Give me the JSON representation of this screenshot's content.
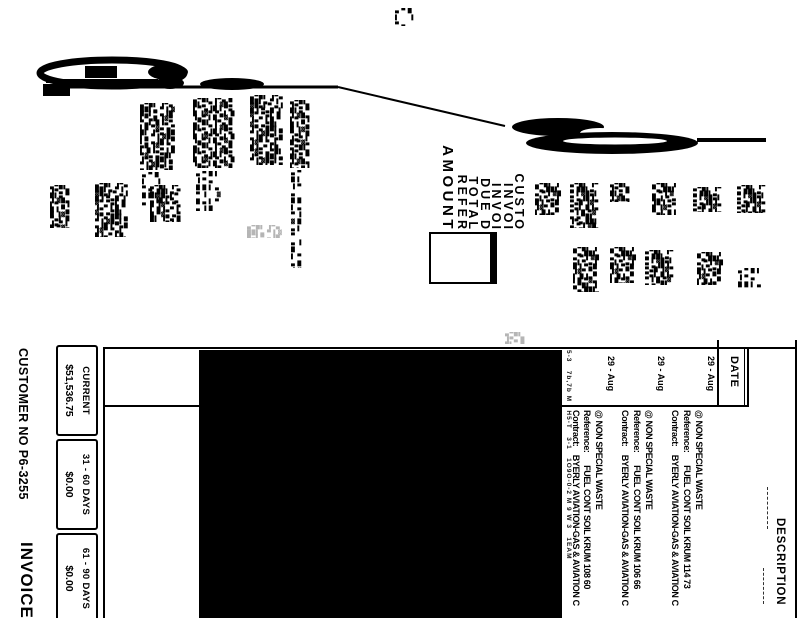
{
  "page": {
    "paper_color": "#ffffff",
    "ink_color": "#000000",
    "redaction_color": "#000000"
  },
  "detail_table": {
    "date_header": "DATE",
    "description_header": "DESCRIPTION",
    "rows": [
      {
        "date": "29 - Aug",
        "item": "@ NON SPECIAL WASTE",
        "reference": "Reference:      FUEL CONT SOIL KRUM 114 73",
        "contract": "Contract:    BYERLY AVIATION-GAS & AVIATION C"
      },
      {
        "date": "29 - Aug",
        "item": "@ NON SPECIAL WASTE",
        "reference": "Reference:      FUEL CONT SOIL KRUM 106 66",
        "contract": "Contract:    BYERLY AVIATION-GAS & AVIATION C"
      },
      {
        "date": "29 - Aug",
        "item": "@ NON SPECIAL WASTE",
        "reference": "Reference:      FUEL CONT SOIL KRUM 108 60",
        "contract": "Contract:    BYERLY AVIATION-GAS & AVIATION C"
      }
    ]
  },
  "aging_table": {
    "cells": [
      {
        "header": "CURRENT",
        "value": "$51,536.75"
      },
      {
        "header": "31 - 60 DAYS",
        "value": "$0.00"
      },
      {
        "header": "61 - 90 DAYS",
        "value": "$0.00"
      }
    ]
  },
  "remit_stub": {
    "labels": [
      "CUSTO",
      "INVOI",
      "INVOI",
      "DUE D",
      "TOTAL",
      "REFER"
    ],
    "amount_label": "AMOUNT"
  },
  "footer": {
    "customer_no": "CUSTOMER NO P6-3255",
    "invoice_title": "INVOICE"
  },
  "artifacts": {
    "fax_line": "5-3   7b,7b M   H5-T   3-1   1O9O-0-2 M 9 W 3   1EAM",
    "noise_glyphs": "▄▀█▌ ▐▀▄ ██▌▄ ▀▐ ▓█▄▌▀ ▄▐█ ▌▀▄█ ▐▓▀ ▀▄▌ █▐▄▀ ▌█ ▀▓▄ ",
    "noise_blocks": [
      {
        "x": 140,
        "y": 103,
        "w": 38,
        "h": 67,
        "style": ""
      },
      {
        "x": 142,
        "y": 172,
        "w": 24,
        "h": 34,
        "style": "light"
      },
      {
        "x": 193,
        "y": 98,
        "w": 44,
        "h": 70,
        "style": ""
      },
      {
        "x": 196,
        "y": 171,
        "w": 30,
        "h": 40,
        "style": "light"
      },
      {
        "x": 250,
        "y": 95,
        "w": 35,
        "h": 70,
        "style": ""
      },
      {
        "x": 290,
        "y": 100,
        "w": 20,
        "h": 68,
        "style": ""
      },
      {
        "x": 291,
        "y": 170,
        "w": 17,
        "h": 98,
        "style": "light"
      },
      {
        "x": 50,
        "y": 185,
        "w": 22,
        "h": 43,
        "style": ""
      },
      {
        "x": 95,
        "y": 183,
        "w": 35,
        "h": 54,
        "style": ""
      },
      {
        "x": 150,
        "y": 185,
        "w": 32,
        "h": 37,
        "style": ""
      },
      {
        "x": 535,
        "y": 183,
        "w": 27,
        "h": 32,
        "style": ""
      },
      {
        "x": 570,
        "y": 183,
        "w": 30,
        "h": 45,
        "style": ""
      },
      {
        "x": 573,
        "y": 247,
        "w": 27,
        "h": 45,
        "style": ""
      },
      {
        "x": 610,
        "y": 183,
        "w": 23,
        "h": 19,
        "style": ""
      },
      {
        "x": 610,
        "y": 247,
        "w": 28,
        "h": 36,
        "style": ""
      },
      {
        "x": 652,
        "y": 183,
        "w": 26,
        "h": 32,
        "style": ""
      },
      {
        "x": 645,
        "y": 250,
        "w": 30,
        "h": 35,
        "style": ""
      },
      {
        "x": 693,
        "y": 187,
        "w": 30,
        "h": 25,
        "style": ""
      },
      {
        "x": 697,
        "y": 252,
        "w": 28,
        "h": 33,
        "style": ""
      },
      {
        "x": 737,
        "y": 185,
        "w": 29,
        "h": 28,
        "style": ""
      },
      {
        "x": 738,
        "y": 268,
        "w": 28,
        "h": 20,
        "style": "light"
      },
      {
        "x": 395,
        "y": 8,
        "w": 25,
        "h": 18,
        "style": "light"
      },
      {
        "x": 247,
        "y": 225,
        "w": 36,
        "h": 13,
        "style": "gray"
      },
      {
        "x": 505,
        "y": 332,
        "w": 22,
        "h": 12,
        "style": "gray"
      }
    ]
  }
}
